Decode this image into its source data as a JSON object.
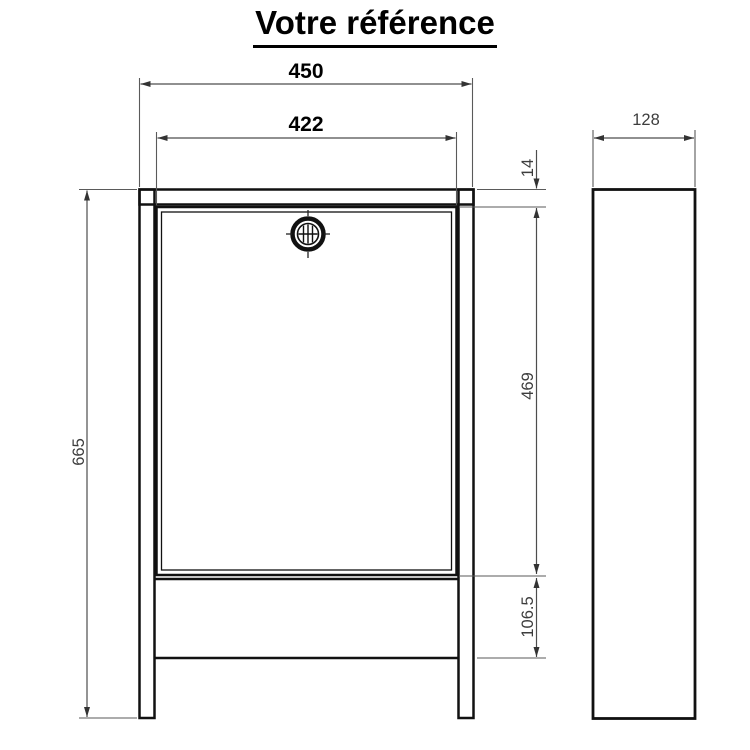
{
  "title": "Votre référence",
  "drawing": {
    "front_view": {
      "label": "front-view",
      "dimensions": {
        "overall_width": "450",
        "door_width": "422",
        "overall_height": "665",
        "frame_top_offset": "14",
        "door_height": "469",
        "bottom_section_height": "106.5"
      }
    },
    "side_view": {
      "label": "side-view",
      "dimensions": {
        "depth": "128"
      }
    }
  },
  "icons": {
    "lock": "lock-icon"
  },
  "colors": {
    "line": "#111111",
    "dimension": "#4d4d4d",
    "background": "#ffffff",
    "text": "#000000"
  }
}
